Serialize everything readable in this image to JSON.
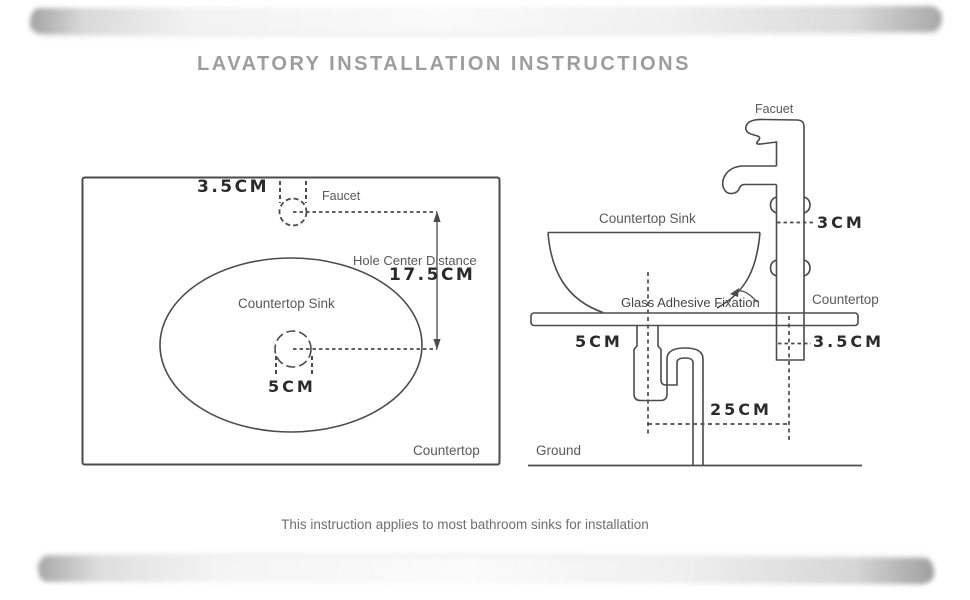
{
  "title": "LAVATORY INSTALLATION INSTRUCTIONS",
  "caption": "This instruction applies to most bathroom sinks for installation",
  "colors": {
    "line": "#4b4b4b",
    "label_text": "#595959",
    "dimension_text": "#2b2b2b",
    "title_text": "#9d9d9d",
    "caption_text": "#6e6e6e",
    "background": "#ffffff"
  },
  "top_view": {
    "faucet_hole_diameter": "3.5CM",
    "faucet_label": "Faucet",
    "hole_center_distance_label": "Hole Center Distance",
    "hole_center_distance_value": "17.5CM",
    "sink_label": "Countertop Sink",
    "drain_hole_diameter": "5CM",
    "countertop_label": "Countertop"
  },
  "side_view": {
    "faucet_label": "Facuet",
    "sink_label": "Countertop Sink",
    "faucet_body_diameter": "3CM",
    "fixation_label": "Glass Adhesive Fixation",
    "countertop_label": "Countertop",
    "drain_diameter": "5CM",
    "faucet_hole_diameter": "3.5CM",
    "drain_to_faucet_distance": "25CM",
    "ground_label": "Ground"
  }
}
